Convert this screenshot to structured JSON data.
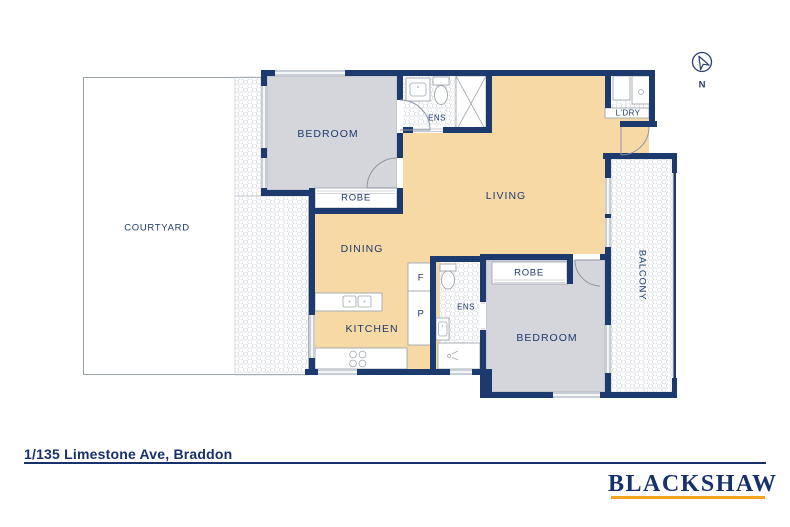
{
  "title": "Floor plan",
  "footer": {
    "address": "1/135 Limestone Ave, Braddon",
    "brand": "BLACKSHAW"
  },
  "compass": {
    "label": "N"
  },
  "colors": {
    "wall_navy": "#1d3a6e",
    "floor_tan": "#f6d9a5",
    "floor_grey": "#d5d5dc",
    "hatch_grey": "#ccd0d6",
    "accent_gold": "#f2a41c",
    "text_navy": "#16316b"
  },
  "rooms": {
    "bedroom1": {
      "label": "BEDROOM"
    },
    "ens1": {
      "label": "ENS"
    },
    "laundry": {
      "label": "L'DRY"
    },
    "living": {
      "label": "LIVING"
    },
    "courtyard": {
      "label": "COURTYARD"
    },
    "robe1": {
      "label": "ROBE"
    },
    "dining": {
      "label": "DINING"
    },
    "fridge": {
      "label": "F"
    },
    "pantry": {
      "label": "P"
    },
    "ens2": {
      "label": "ENS"
    },
    "kitchen": {
      "label": "KITCHEN"
    },
    "robe2": {
      "label": "ROBE"
    },
    "bedroom2": {
      "label": "BEDROOM"
    },
    "balcony": {
      "label": "BALCONY"
    }
  }
}
